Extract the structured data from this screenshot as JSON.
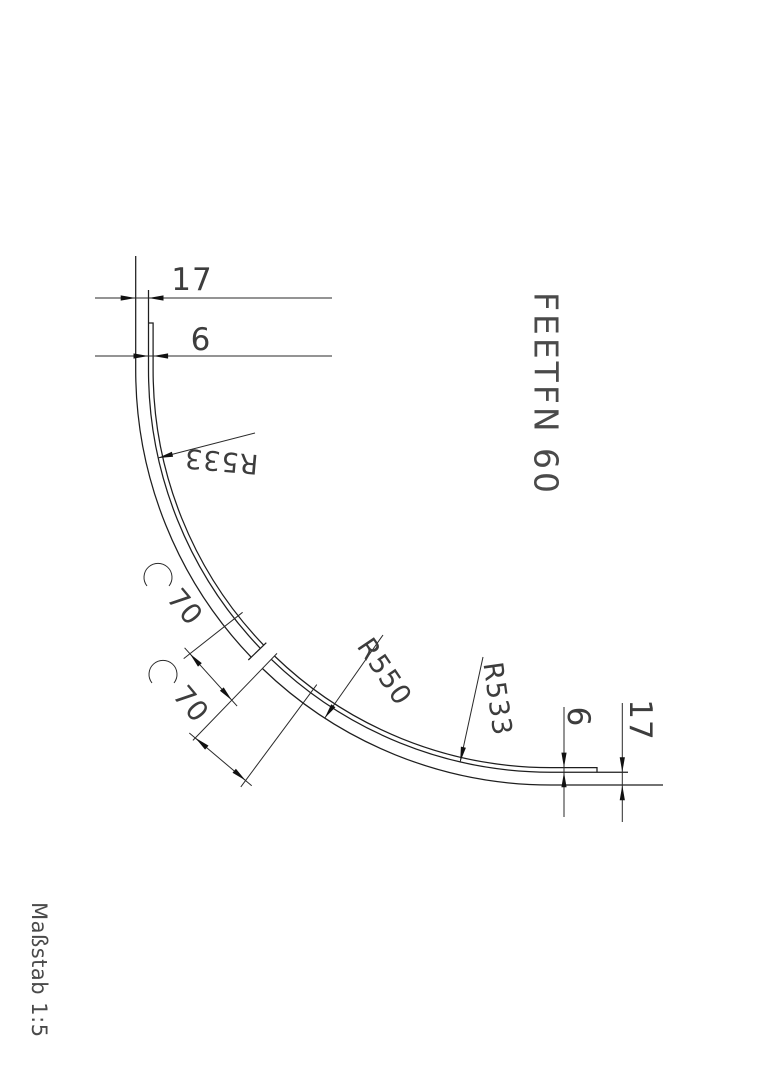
{
  "title": "FEETFN 60",
  "scale_label": "Maßstab 1:5",
  "dimensions": {
    "top_width": "17",
    "top_liner": "6",
    "arc_length_1": "70",
    "arc_length_2": "70",
    "right_liner": "6",
    "right_width": "17"
  },
  "radius_labels": {
    "inner_top": "R533",
    "outer": "R550",
    "inner_bottom": "R533"
  },
  "line_color": "#1e1e1e",
  "text_color": "#3d3d3d",
  "background_color": "#ffffff"
}
